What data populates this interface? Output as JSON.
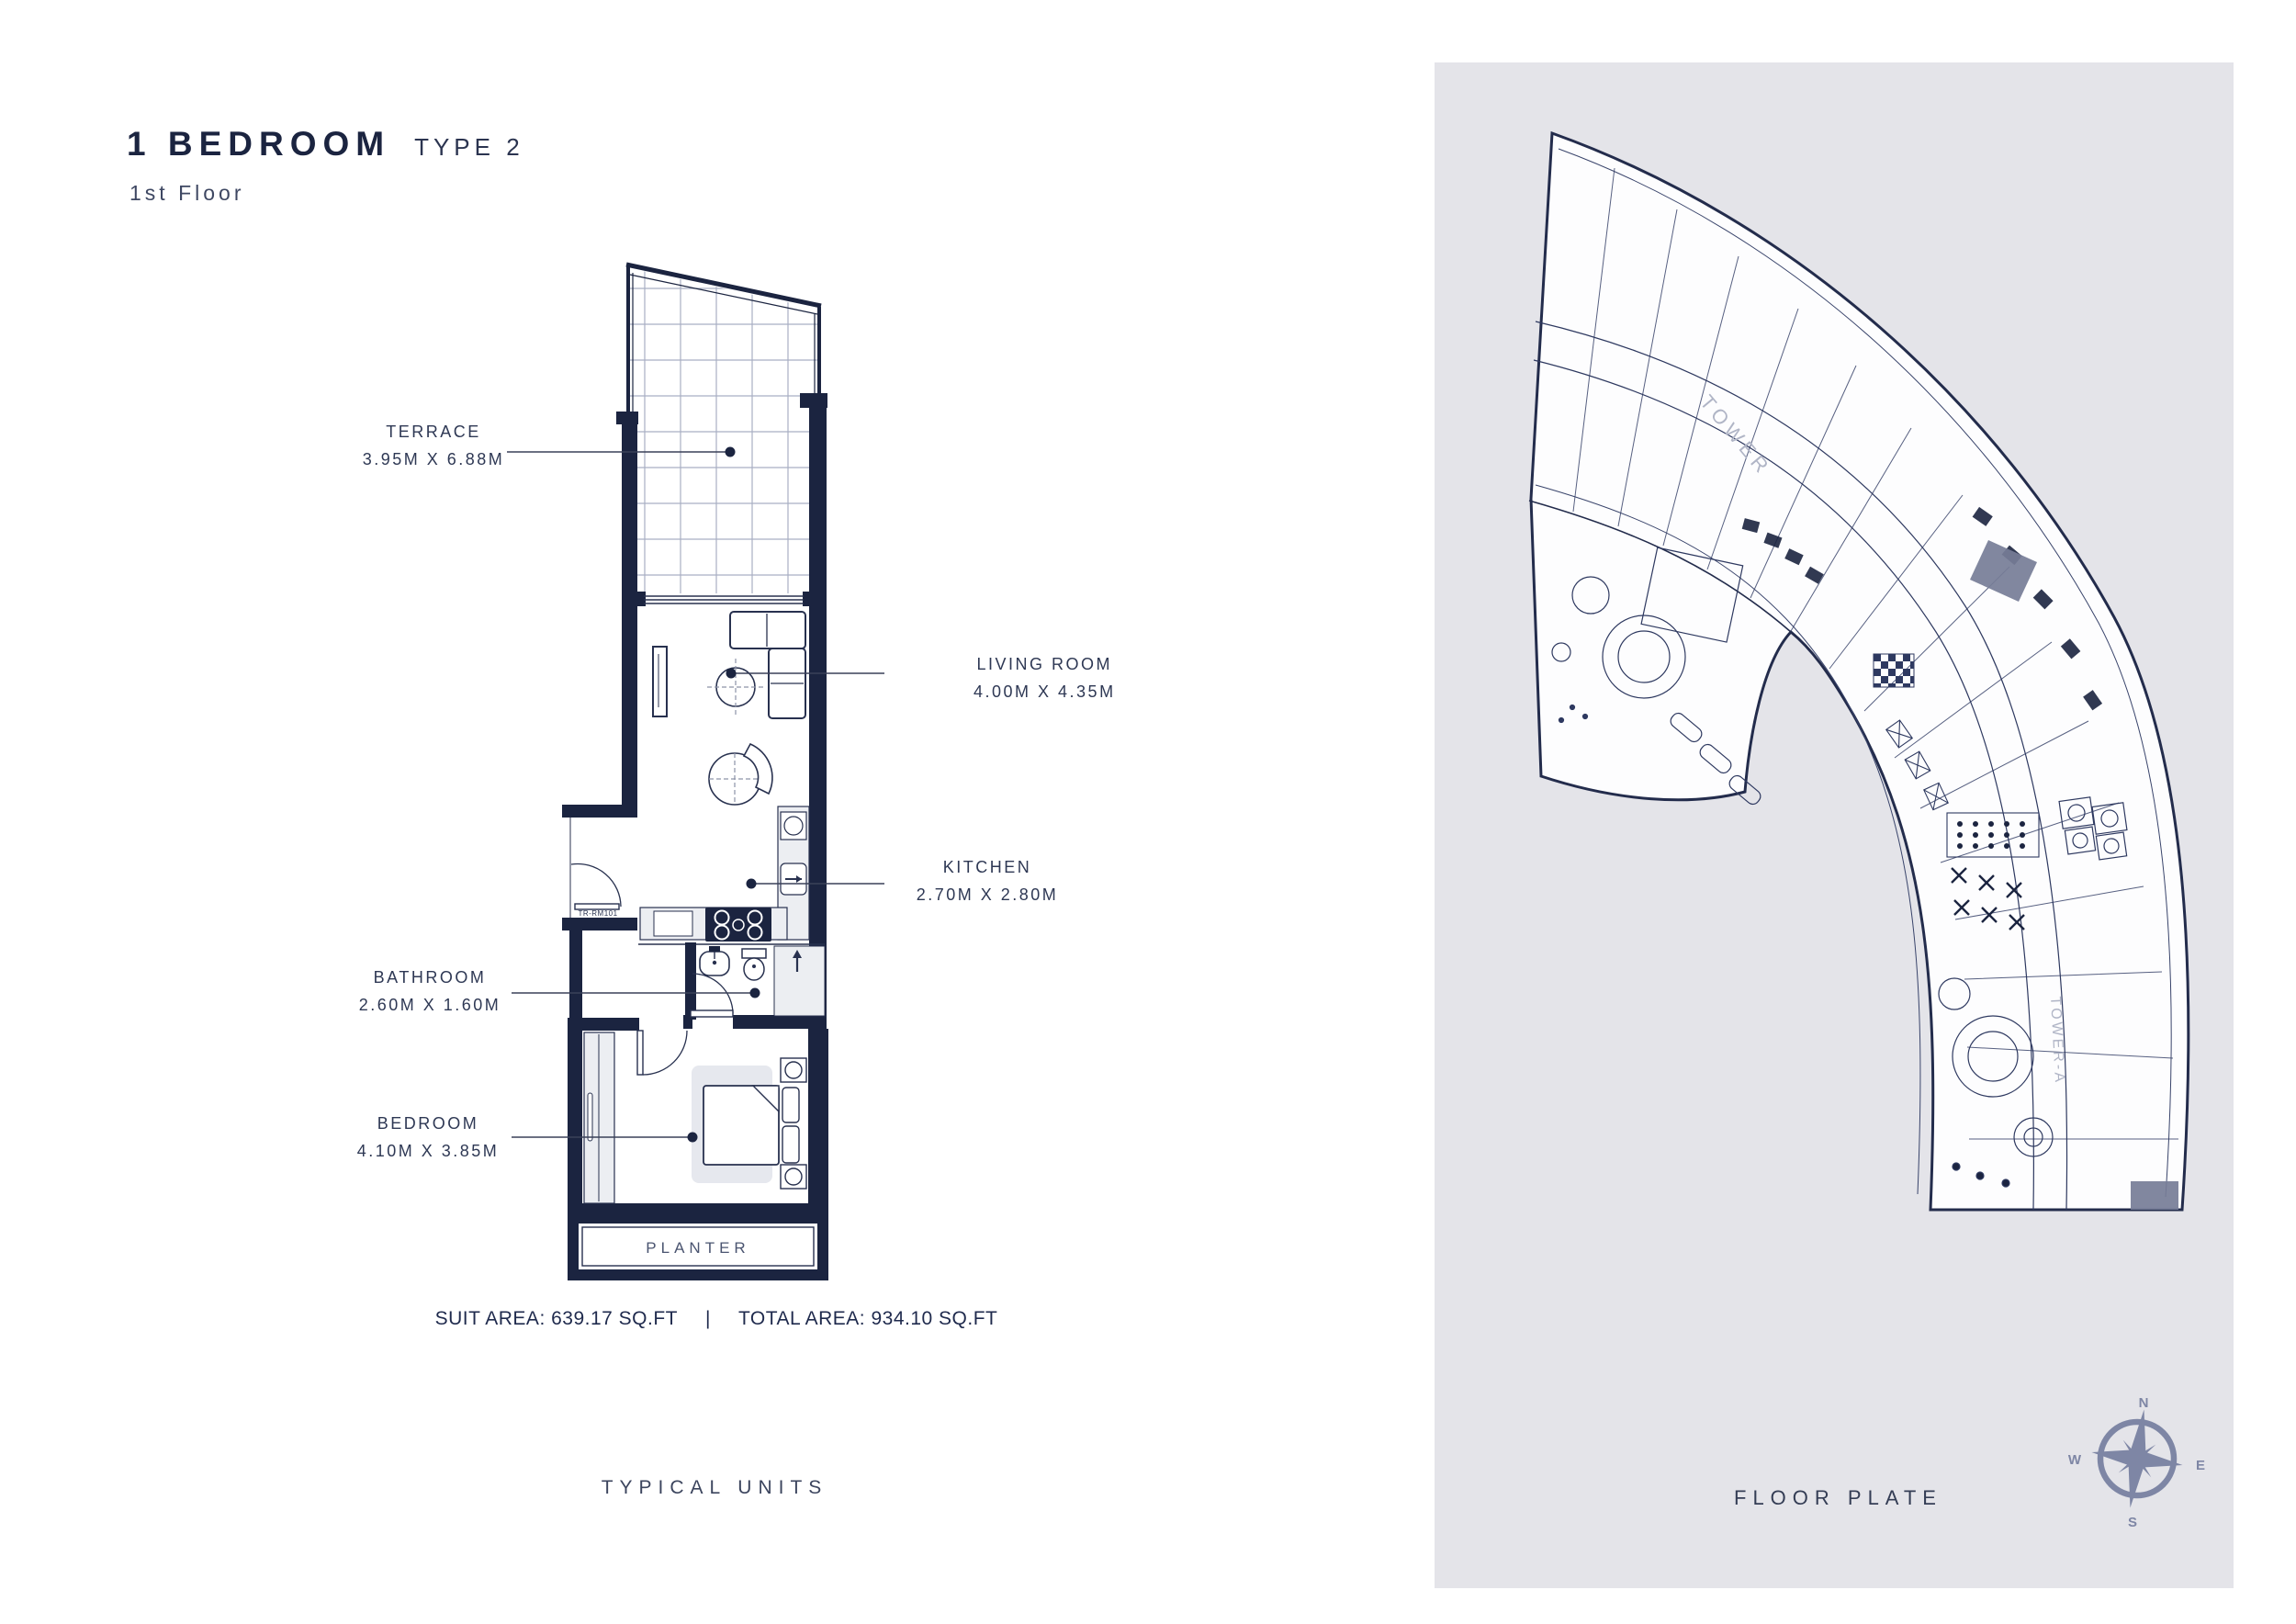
{
  "page": {
    "title": "1 BEDROOM",
    "type_label": "TYPE 2",
    "subtitle": "1st Floor"
  },
  "unit_plan": {
    "rooms": [
      {
        "id": "terrace",
        "name": "TERRACE",
        "dims": "3.95M X 6.88M"
      },
      {
        "id": "living-room",
        "name": "LIVING ROOM",
        "dims": "4.00M X 4.35M"
      },
      {
        "id": "kitchen",
        "name": "KITCHEN",
        "dims": "2.70M X 2.80M"
      },
      {
        "id": "bathroom",
        "name": "BATHROOM",
        "dims": "2.60M X 1.60M"
      },
      {
        "id": "bedroom",
        "name": "BEDROOM",
        "dims": "4.10M X 3.85M"
      }
    ],
    "planter_label": "PLANTER",
    "entry_tag": "TR-RM101",
    "suit_area": "SUIT AREA: 639.17 SQ.FT",
    "separator": "|",
    "total_area": "TOTAL AREA: 934.10 SQ.FT",
    "caption": "TYPICAL UNITS"
  },
  "floor_plate": {
    "caption": "FLOOR PLATE",
    "tower_label": "TOWER",
    "tower_label_vertical": "TOWER-A",
    "compass": {
      "north": "N",
      "east": "E",
      "south": "S",
      "west": "W"
    }
  },
  "colors": {
    "navy": "#1b2440",
    "panel_gray": "#e4e4e9",
    "compass_gray": "#7e86a5",
    "plan_line": "#2e3960",
    "light_fill": "#eceef2"
  }
}
